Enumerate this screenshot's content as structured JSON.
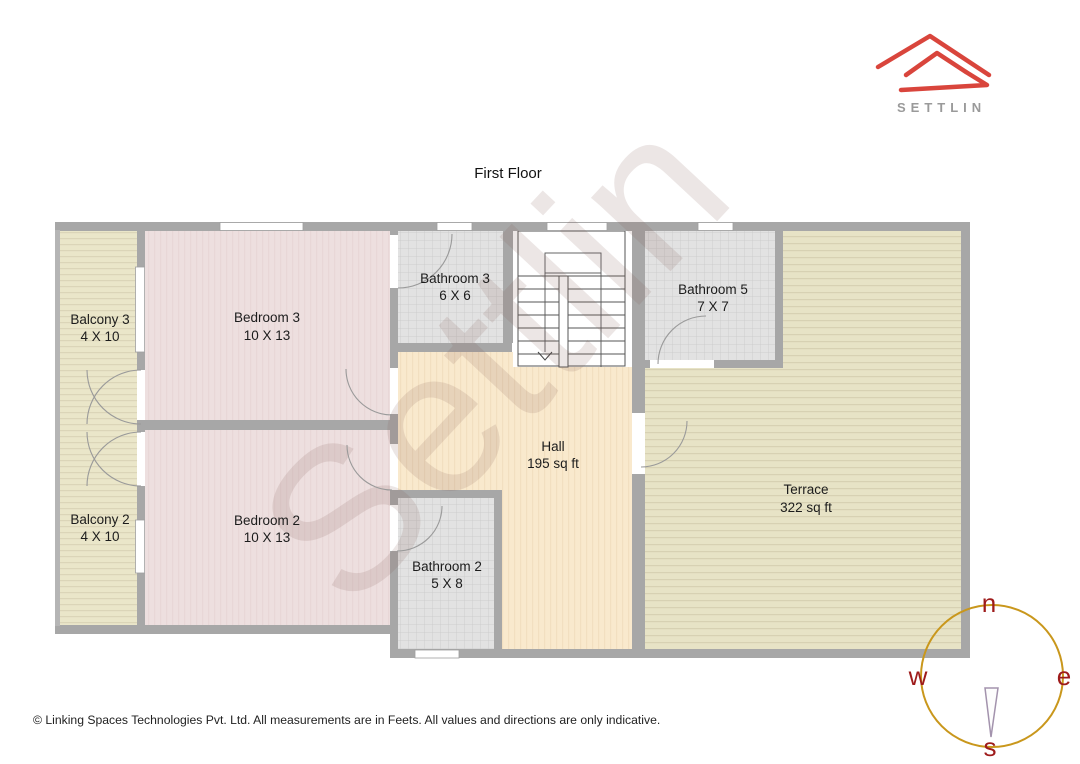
{
  "title": "First Floor",
  "logo": {
    "brand": "SETTLIN",
    "roof_color": "#d9453c",
    "text_color": "#9a9a9a"
  },
  "watermark": "Settlin",
  "rooms": {
    "balcony3": {
      "name": "Balcony 3",
      "dims": "4 X 10"
    },
    "bedroom3": {
      "name": "Bedroom 3",
      "dims": "10 X 13"
    },
    "bathroom3": {
      "name": "Bathroom 3",
      "dims": "6 X 6"
    },
    "bathroom5": {
      "name": "Bathroom 5",
      "dims": "7 X 7"
    },
    "hall": {
      "name": "Hall",
      "dims": "195 sq ft"
    },
    "terrace": {
      "name": "Terrace",
      "dims": "322 sq ft"
    },
    "balcony2": {
      "name": "Balcony 2",
      "dims": "4 X 10"
    },
    "bedroom2": {
      "name": "Bedroom 2",
      "dims": "10 X 13"
    },
    "bathroom2": {
      "name": "Bathroom 2",
      "dims": "5 X 8"
    }
  },
  "compass": {
    "north": "n",
    "east": "e",
    "west": "w",
    "south": "s",
    "ring_color": "#c9971c",
    "letter_color": "#9e1b1b"
  },
  "footer": "© Linking Spaces Technologies Pvt. Ltd. All measurements are in Feets. All values and directions are only indicative."
}
